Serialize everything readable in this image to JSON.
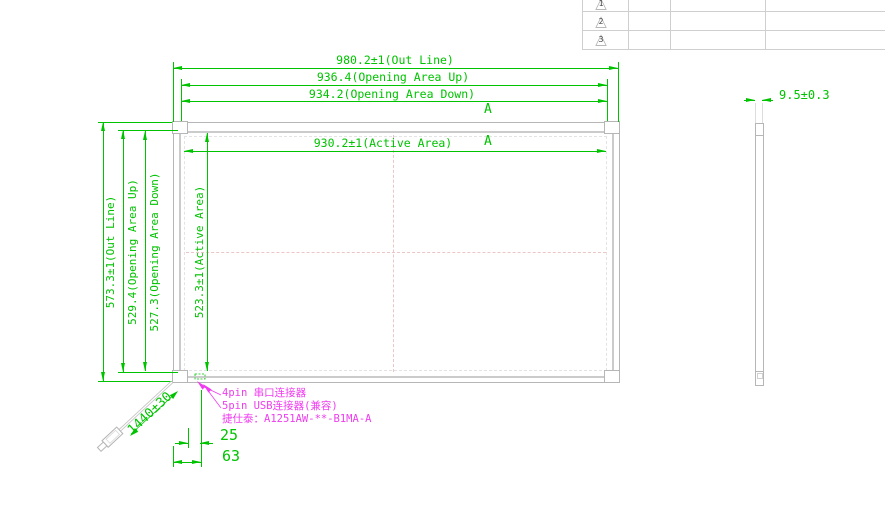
{
  "table": {
    "rows": [
      {
        "marker": "1"
      },
      {
        "marker": "2"
      },
      {
        "marker": "3"
      }
    ]
  },
  "dims": {
    "top": [
      {
        "label": "980.2±1(Out Line)"
      },
      {
        "label": "936.4(Opening Area Up)"
      },
      {
        "label": "934.2(Opening Area Down)"
      },
      {
        "label": "930.2±1(Active Area)"
      }
    ],
    "left": [
      {
        "label": "573.3±1(Out Line)"
      },
      {
        "label": "529.4(Opening Area Up)"
      },
      {
        "label": "527.3(Opening Area Down)"
      },
      {
        "label": "523.3±1(Active Area)"
      }
    ],
    "thickness": "9.5±0.3",
    "cable_length": "1440±30",
    "offset_small": "25",
    "offset_large": "63"
  },
  "section": {
    "marker_top": "A",
    "marker_bottom": "A"
  },
  "notes": {
    "line1": "4pin 串口连接器",
    "line2": "5pin USB连接器(兼容)",
    "line3": "捷仕泰：A1251AW-**-B1MA-A"
  },
  "colors": {
    "dimension_green": "#00c300",
    "note_magenta": "#ef3cef",
    "outline_gray": "#b6b6b6",
    "centerline_pink": "#ecc6c6"
  }
}
